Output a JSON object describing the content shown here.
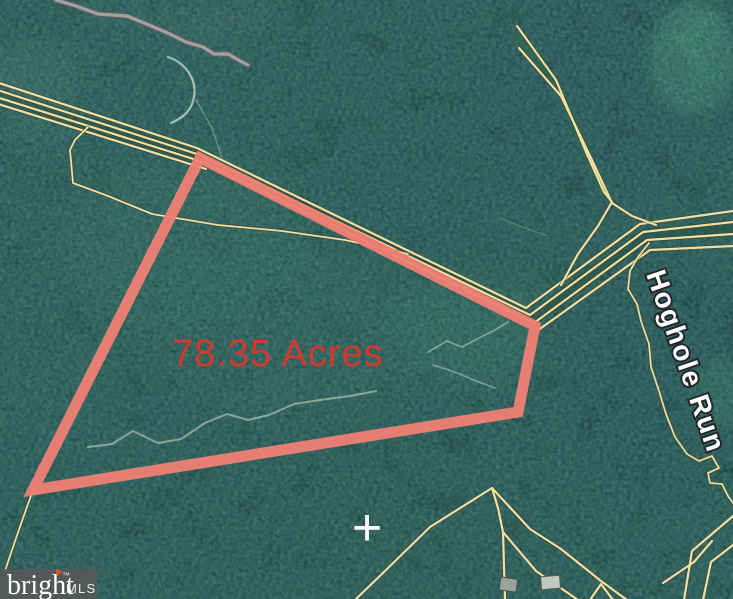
{
  "map": {
    "acreage_label": "78.35 Acres",
    "road_label": "Hoghole Run",
    "center_marker": "+",
    "colors": {
      "parcel_outline": "#ef8074",
      "acreage_text": "#d6382d",
      "boundary_yellow": "#f2dfa3",
      "gray_road": "#a2a2a2",
      "forest_base": "#183f3d",
      "clearing_green": "#3f9169",
      "label_white": "#ffffff"
    }
  },
  "watermark": {
    "brand": "bright",
    "trademark": "™",
    "suffix": "MLS"
  }
}
